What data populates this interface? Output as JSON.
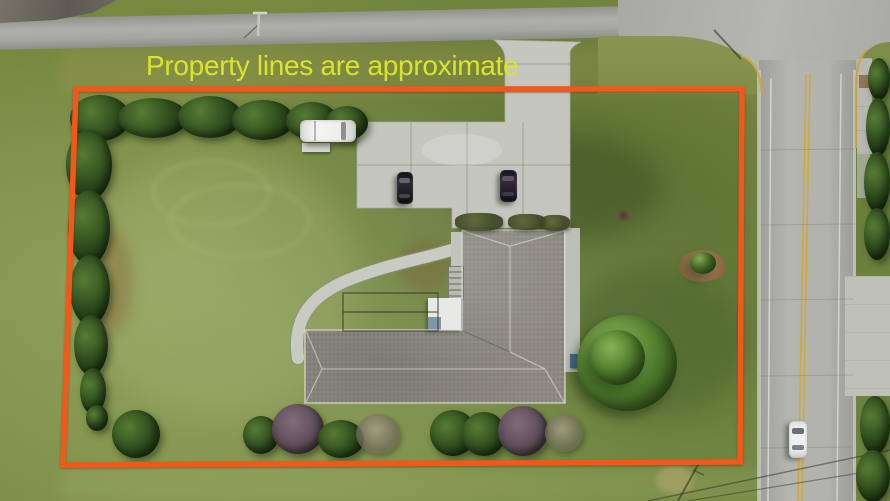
{
  "annotation": {
    "text": "Property lines are approximate"
  },
  "theme": {
    "boundary_orange": "#f4571a",
    "text_yellow": "#d9e52b",
    "grass_base": "#77893f",
    "asphalt": "#a3a3a0",
    "concrete_road": "#b3b3af",
    "concrete_drive": "#c5c7bf",
    "roof_gray": "#8f8c85",
    "hedge_green": "#2c421b",
    "tree_green": "#4e7a2b",
    "shrub_purple": "#5c4a58",
    "line_yellow": "#cfa83e",
    "line_white": "#dcdcd8",
    "mulch_tan": "#a5845a"
  },
  "scene": {
    "vehicles_visible": 4,
    "buildings_visible": 1,
    "elements": [
      "L-shaped house with gray shingle roof",
      "concrete driveway and parking pad",
      "curved front walkway",
      "white van parked on grass",
      "two dark cars on parking pad",
      "white car driving on right road",
      "hedgerow along top and left boundary",
      "large tree east of house",
      "shrub row along bottom boundary",
      "road intersection at top right",
      "orange approximate property boundary"
    ]
  }
}
